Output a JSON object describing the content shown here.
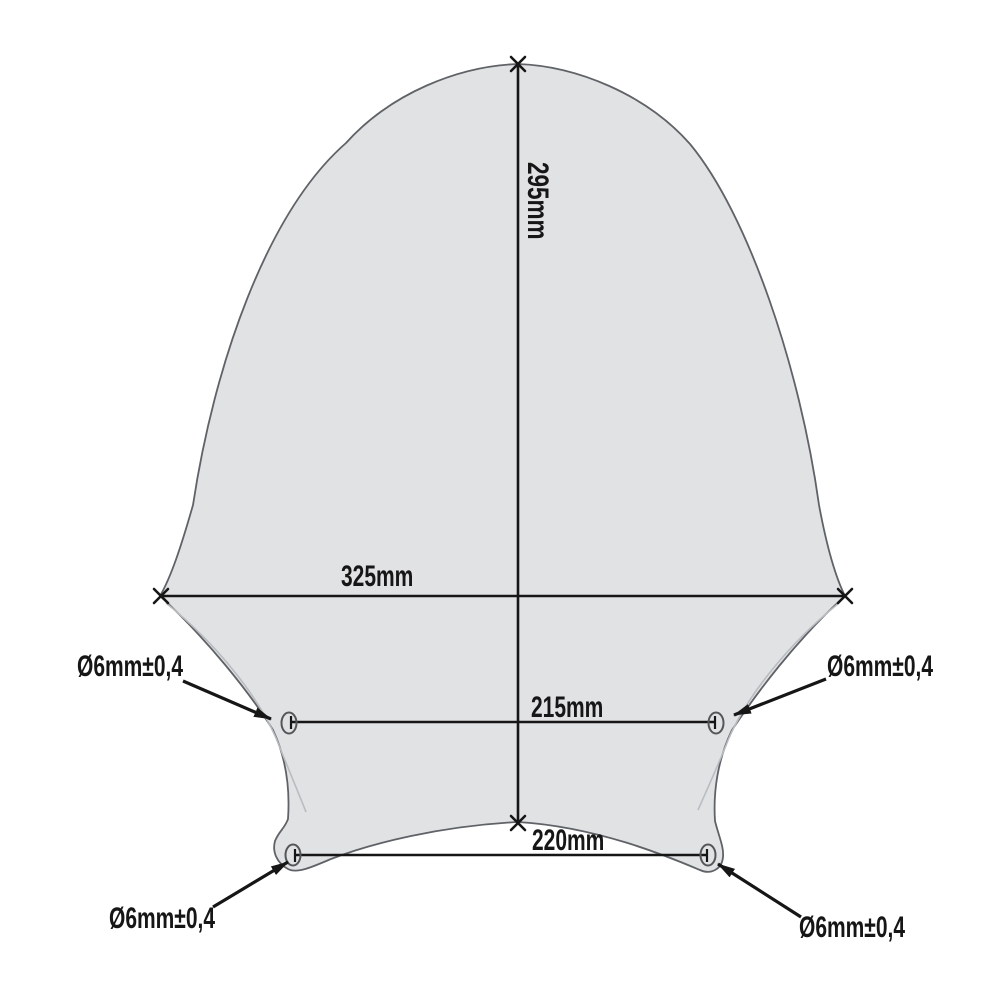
{
  "diagram": {
    "subject": "windscreen-dimension-drawing",
    "dimensions": {
      "height": "295mm",
      "max_width": "325mm",
      "mid_hole_span": "215mm",
      "bottom_hole_span": "220mm"
    },
    "hole_labels": {
      "mid_left": "Ø6mm±0,4",
      "mid_right": "Ø6mm±0,4",
      "bottom_left": "Ø6mm±0,4",
      "bottom_right": "Ø6mm±0,4"
    },
    "colors": {
      "background": "#ffffff",
      "shape_fill": "#e1e2e4",
      "shape_outline": "#5f6266",
      "fold_line": "#b9bcc0",
      "dimension_line": "#161616"
    }
  }
}
